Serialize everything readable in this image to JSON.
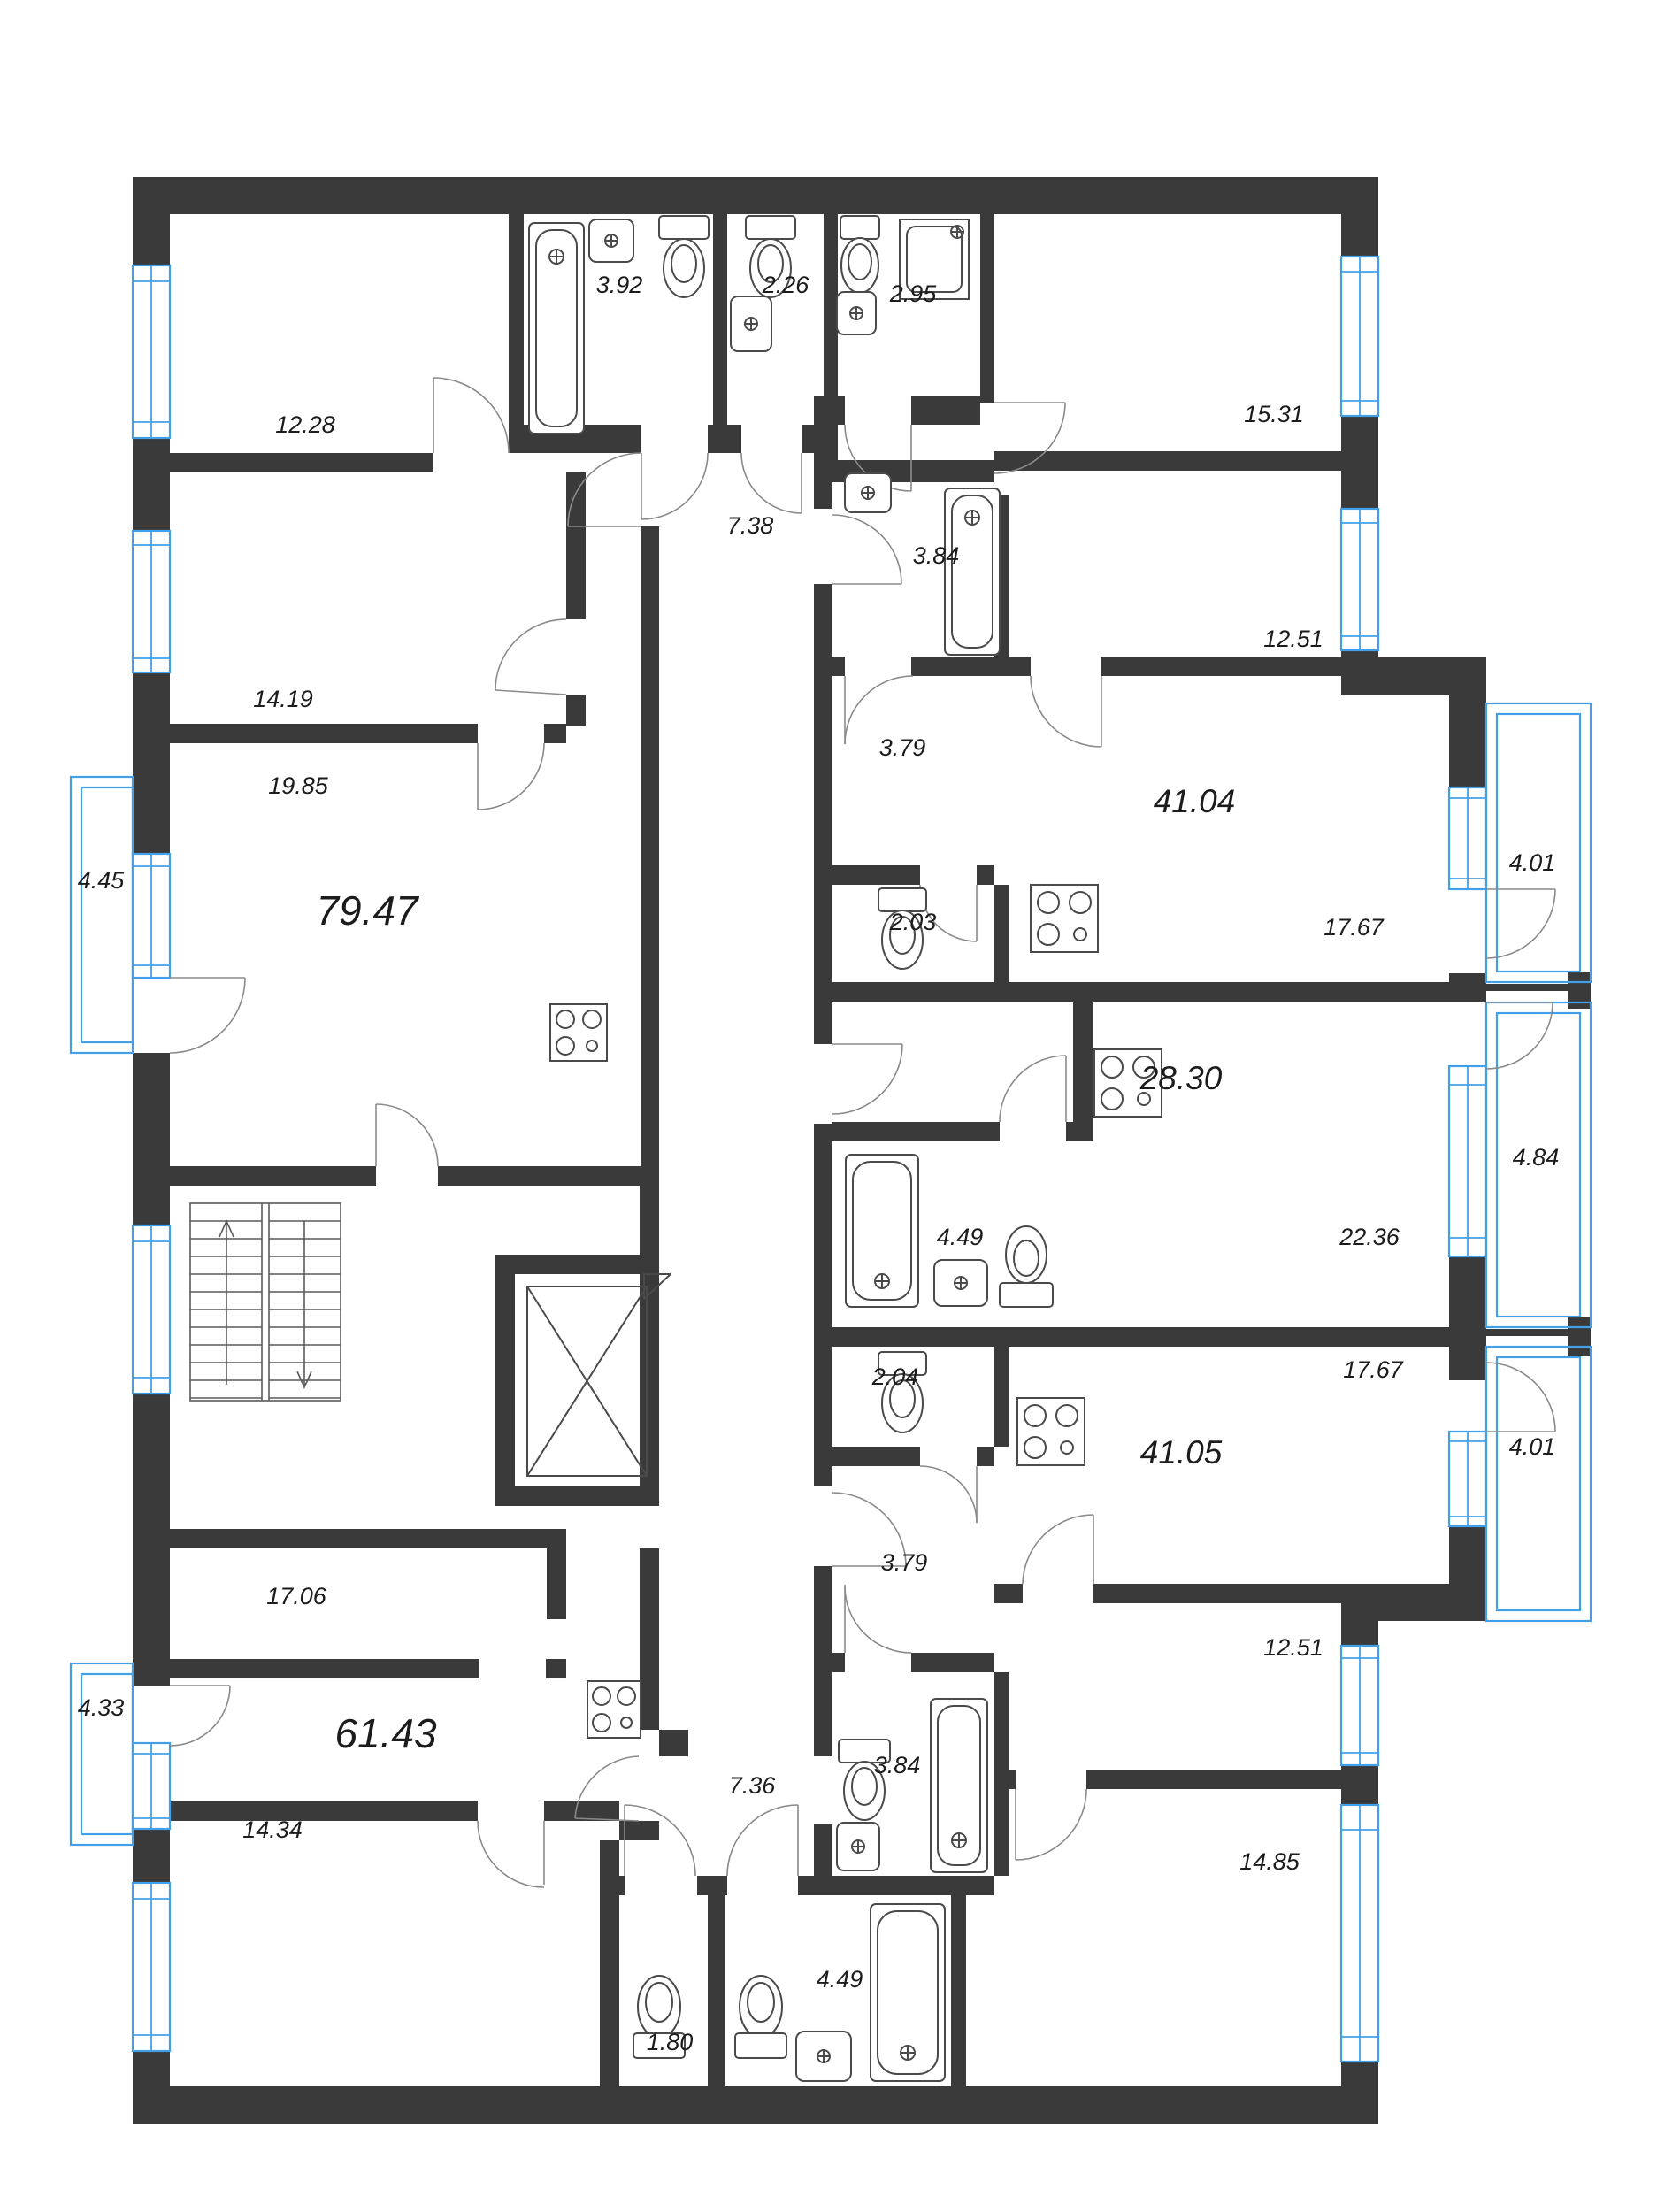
{
  "plan": {
    "type": "floor-plan",
    "colors": {
      "wall": "#3a3a3a",
      "window": "#42a0ea",
      "fixture": "#4a4a4a",
      "door_arc": "#8a8a8a",
      "text": "#1c1c1c",
      "background": "#ffffff"
    },
    "labels": [
      {
        "id": "room-12-28",
        "text": "12.28"
      },
      {
        "id": "bath-3-92",
        "text": "3.92"
      },
      {
        "id": "wc-2-26",
        "text": "2.26"
      },
      {
        "id": "shower-2-95",
        "text": "2.95"
      },
      {
        "id": "room-15-31",
        "text": "15.31"
      },
      {
        "id": "corridor-7-38",
        "text": "7.38"
      },
      {
        "id": "bath-3-84-top",
        "text": "3.84"
      },
      {
        "id": "room-12-51-top",
        "text": "12.51"
      },
      {
        "id": "room-14-19",
        "text": "14.19"
      },
      {
        "id": "room-19-85",
        "text": "19.85"
      },
      {
        "id": "hall-3-79-top",
        "text": "3.79"
      },
      {
        "id": "apt-41-04",
        "text": "41.04"
      },
      {
        "id": "balcony-4-45",
        "text": "4.45"
      },
      {
        "id": "apt-79-47",
        "text": "79.47"
      },
      {
        "id": "balcony-4-01-top",
        "text": "4.01"
      },
      {
        "id": "wc-2-03",
        "text": "2.03"
      },
      {
        "id": "kitchen-17-67-top",
        "text": "17.67"
      },
      {
        "id": "apt-28-30",
        "text": "28.30"
      },
      {
        "id": "balcony-4-84",
        "text": "4.84"
      },
      {
        "id": "bath-4-49-mid",
        "text": "4.49"
      },
      {
        "id": "room-22-36",
        "text": "22.36"
      },
      {
        "id": "wc-2-04",
        "text": "2.04"
      },
      {
        "id": "kitchen-17-67-bot",
        "text": "17.67"
      },
      {
        "id": "apt-41-05",
        "text": "41.05"
      },
      {
        "id": "balcony-4-01-bot",
        "text": "4.01"
      },
      {
        "id": "hall-3-79-bot",
        "text": "3.79"
      },
      {
        "id": "room-17-06",
        "text": "17.06"
      },
      {
        "id": "room-12-51-bot",
        "text": "12.51"
      },
      {
        "id": "balcony-4-33",
        "text": "4.33"
      },
      {
        "id": "apt-61-43",
        "text": "61.43"
      },
      {
        "id": "bath-3-84-bot",
        "text": "3.84"
      },
      {
        "id": "corridor-7-36",
        "text": "7.36"
      },
      {
        "id": "room-14-34",
        "text": "14.34"
      },
      {
        "id": "room-14-85",
        "text": "14.85"
      },
      {
        "id": "wc-1-80",
        "text": "1.80"
      },
      {
        "id": "bath-4-49-bot",
        "text": "4.49"
      }
    ]
  }
}
